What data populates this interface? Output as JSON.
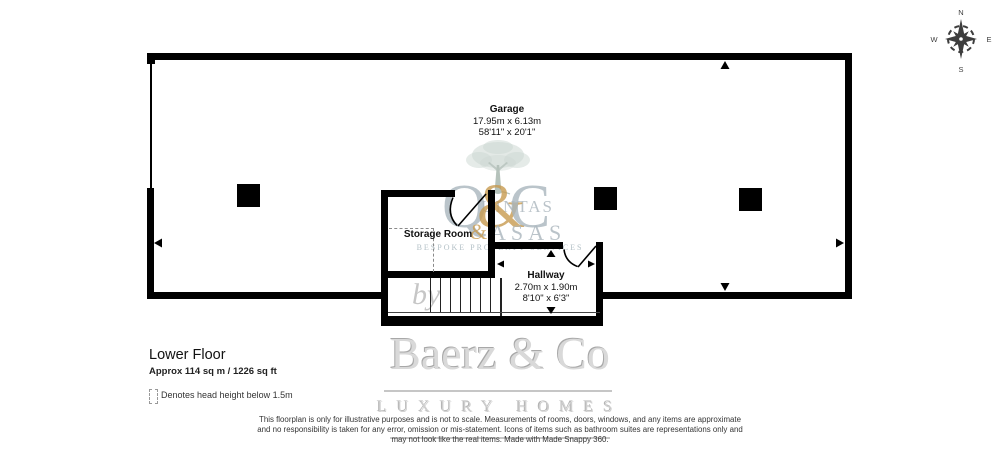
{
  "title": {
    "floor": "Lower Floor",
    "area": "Approx 114 sq m / 1226 sq ft"
  },
  "legend": {
    "label": "Denotes head height below 1.5m"
  },
  "plan": {
    "rooms": [
      {
        "name": "Garage",
        "dim_metric": "17.95m x 6.13m",
        "dim_imperial": "58'11\" x 20'1\""
      },
      {
        "name": "Storage Room"
      },
      {
        "name": "Hallway",
        "dim_metric": "2.70m x 1.90m",
        "dim_imperial": "8'10\" x 6'3\""
      }
    ]
  },
  "compass": {
    "n": "N",
    "e": "E",
    "s": "S",
    "w": "W"
  },
  "watermark": {
    "monogram": {
      "q": "Q",
      "amp": "&",
      "c": "C",
      "word_top": "UINTAS",
      "amp_small": "&",
      "word_bottom": "ASAS"
    },
    "tagline": "BESPOKE PROPERTY SERVICES",
    "by": "by",
    "brand": "Baerz & Co",
    "brand_sub": "LUXURY HOMES"
  },
  "disclaimer": {
    "lines": [
      "This floorplan is only for illustrative purposes and is not to scale. Measurements of rooms, doors, windows, and any items are approximate",
      "and no responsibility is taken for any error, omission or mis-statement. Icons of items such as bathroom suites are representations only and",
      "may not look like the real items. Made with Made Snappy 360."
    ]
  },
  "colors": {
    "walls": "#000000",
    "monogram_gray": "#a9b6bd",
    "monogram_gold": "#c79b50",
    "tagline_blue": "#b4c1c7",
    "brand_gray": "#d9d9d9",
    "tree_green": "#ccd7d1",
    "compass_ink": "#3d3d3d"
  }
}
